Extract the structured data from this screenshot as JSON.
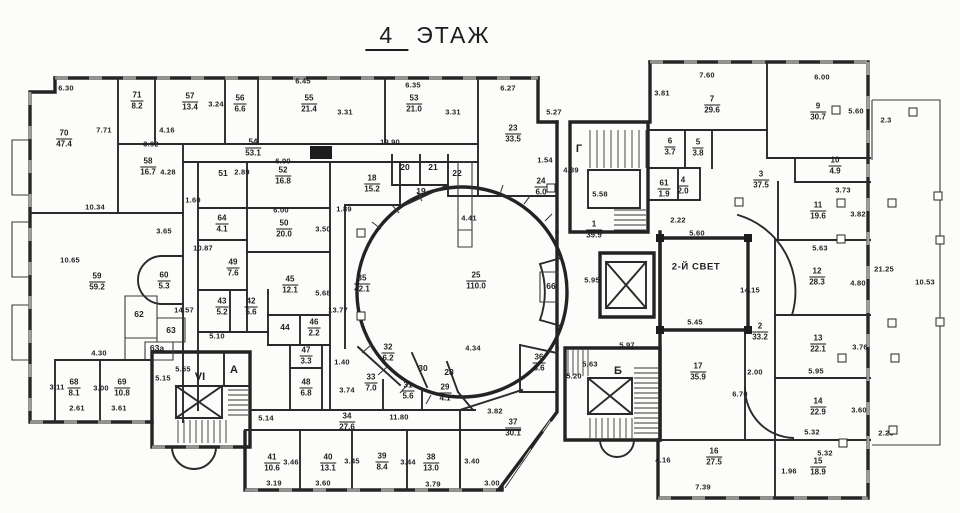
{
  "title": {
    "number": "4",
    "word": "ЭТАЖ"
  },
  "plan": {
    "ink": "#1f1f1f",
    "rooms": [
      {
        "num": "70",
        "area": "47.4",
        "pos": [
          64,
          139
        ]
      },
      {
        "num": "71",
        "area": "8.2",
        "pos": [
          137,
          101
        ]
      },
      {
        "num": "57",
        "area": "13.4",
        "pos": [
          190,
          102
        ]
      },
      {
        "num": "56",
        "area": "6.6",
        "pos": [
          240,
          104
        ]
      },
      {
        "num": "55",
        "area": "21.4",
        "pos": [
          309,
          104
        ]
      },
      {
        "num": "53",
        "area": "21.0",
        "pos": [
          414,
          104
        ]
      },
      {
        "num": "23",
        "area": "33.5",
        "pos": [
          513,
          134
        ]
      },
      {
        "num": "54",
        "area": "53.1",
        "pos": [
          253,
          148
        ]
      },
      {
        "num": "58",
        "area": "16.7",
        "pos": [
          148,
          167
        ]
      },
      {
        "num": "52",
        "area": "16.8",
        "pos": [
          283,
          176
        ]
      },
      {
        "num": "18",
        "area": "15.2",
        "pos": [
          372,
          184
        ]
      },
      {
        "num": "24",
        "area": "6.0",
        "pos": [
          541,
          187
        ]
      },
      {
        "num": "64",
        "area": "4.1",
        "pos": [
          222,
          224
        ]
      },
      {
        "num": "50",
        "area": "20.0",
        "pos": [
          284,
          229
        ]
      },
      {
        "num": "49",
        "area": "7.6",
        "pos": [
          233,
          268
        ]
      },
      {
        "num": "59",
        "area": "59.2",
        "pos": [
          97,
          282
        ]
      },
      {
        "num": "60",
        "area": "5.3",
        "pos": [
          164,
          281
        ]
      },
      {
        "num": "45",
        "area": "12.1",
        "pos": [
          290,
          285
        ]
      },
      {
        "num": "35",
        "area": "42.1",
        "pos": [
          362,
          284
        ]
      },
      {
        "num": "25",
        "area": "110.0",
        "pos": [
          476,
          281
        ]
      },
      {
        "num": "43",
        "area": "5.2",
        "pos": [
          222,
          307
        ]
      },
      {
        "num": "42",
        "area": "5.6",
        "pos": [
          251,
          307
        ]
      },
      {
        "num": "46",
        "area": "2.2",
        "pos": [
          314,
          328
        ]
      },
      {
        "num": "47",
        "area": "3.3",
        "pos": [
          306,
          356
        ]
      },
      {
        "num": "48",
        "area": "6.8",
        "pos": [
          306,
          388
        ]
      },
      {
        "num": "32",
        "area": "6.2",
        "pos": [
          388,
          353
        ]
      },
      {
        "num": "33",
        "area": "7.0",
        "pos": [
          371,
          383
        ]
      },
      {
        "num": "31",
        "area": "5.6",
        "pos": [
          408,
          391
        ]
      },
      {
        "num": "29",
        "area": "4.1",
        "pos": [
          445,
          393
        ]
      },
      {
        "num": "34",
        "area": "27.6",
        "pos": [
          347,
          422
        ]
      },
      {
        "num": "68",
        "area": "8.1",
        "pos": [
          74,
          388
        ]
      },
      {
        "num": "69",
        "area": "10.8",
        "pos": [
          122,
          388
        ]
      },
      {
        "num": "41",
        "area": "10.6",
        "pos": [
          272,
          463
        ]
      },
      {
        "num": "40",
        "area": "13.1",
        "pos": [
          328,
          463
        ]
      },
      {
        "num": "39",
        "area": "8.4",
        "pos": [
          382,
          462
        ]
      },
      {
        "num": "38",
        "area": "13.0",
        "pos": [
          431,
          463
        ]
      },
      {
        "num": "37",
        "area": "30.1",
        "pos": [
          513,
          428
        ]
      },
      {
        "num": "36",
        "area": "6.6",
        "pos": [
          539,
          363
        ]
      },
      {
        "num": "1",
        "area": "39.9",
        "pos": [
          594,
          230
        ]
      },
      {
        "num": "7",
        "area": "29.6",
        "pos": [
          712,
          105
        ]
      },
      {
        "num": "9",
        "area": "30.7",
        "pos": [
          818,
          112
        ]
      },
      {
        "num": "6",
        "area": "3.7",
        "pos": [
          670,
          147
        ]
      },
      {
        "num": "5",
        "area": "3.8",
        "pos": [
          698,
          148
        ]
      },
      {
        "num": "61",
        "area": "1.9",
        "pos": [
          664,
          189
        ]
      },
      {
        "num": "4",
        "area": "2.0",
        "pos": [
          683,
          186
        ]
      },
      {
        "num": "3",
        "area": "37.5",
        "pos": [
          761,
          180
        ]
      },
      {
        "num": "10",
        "area": "4.9",
        "pos": [
          835,
          166
        ]
      },
      {
        "num": "11",
        "area": "19.6",
        "pos": [
          818,
          211
        ]
      },
      {
        "num": "12",
        "area": "28.3",
        "pos": [
          817,
          277
        ]
      },
      {
        "num": "2",
        "area": "33.2",
        "pos": [
          760,
          332
        ]
      },
      {
        "num": "13",
        "area": "22.1",
        "pos": [
          818,
          344
        ]
      },
      {
        "num": "17",
        "area": "35.9",
        "pos": [
          698,
          372
        ]
      },
      {
        "num": "14",
        "area": "22.9",
        "pos": [
          818,
          407
        ]
      },
      {
        "num": "16",
        "area": "27.5",
        "pos": [
          714,
          457
        ]
      },
      {
        "num": "15",
        "area": "18.9",
        "pos": [
          818,
          467
        ]
      }
    ],
    "cells": [
      {
        "num": "51",
        "pos": [
          223,
          173
        ]
      },
      {
        "num": "20",
        "pos": [
          405,
          167
        ]
      },
      {
        "num": "21",
        "pos": [
          433,
          167
        ]
      },
      {
        "num": "22",
        "pos": [
          457,
          173
        ]
      },
      {
        "num": "19",
        "pos": [
          421,
          191
        ]
      },
      {
        "num": "30",
        "pos": [
          423,
          368
        ]
      },
      {
        "num": "28",
        "pos": [
          449,
          372
        ]
      },
      {
        "num": "44",
        "pos": [
          285,
          327
        ]
      },
      {
        "num": "62",
        "pos": [
          139,
          314
        ]
      },
      {
        "num": "63",
        "pos": [
          171,
          330
        ]
      },
      {
        "num": "63а",
        "pos": [
          157,
          348
        ]
      },
      {
        "num": "66",
        "pos": [
          551,
          286
        ]
      }
    ],
    "zones": [
      {
        "label": "Г",
        "pos": [
          579,
          149
        ],
        "wide": false
      },
      {
        "label": "Б",
        "pos": [
          618,
          371
        ],
        "wide": false
      },
      {
        "label": "VI",
        "pos": [
          200,
          377
        ],
        "wide": false
      },
      {
        "label": "А",
        "pos": [
          234,
          370
        ],
        "wide": false
      },
      {
        "label": "2-Й СВЕТ",
        "pos": [
          696,
          267
        ],
        "wide": true
      }
    ],
    "dims": [
      {
        "t": "6.30",
        "pos": [
          66,
          88
        ]
      },
      {
        "t": "7.71",
        "pos": [
          104,
          130
        ],
        "v": true
      },
      {
        "t": "3.92",
        "pos": [
          151,
          144
        ]
      },
      {
        "t": "4.16",
        "pos": [
          167,
          130
        ]
      },
      {
        "t": "3.24",
        "pos": [
          216,
          104
        ],
        "v": true
      },
      {
        "t": "6.45",
        "pos": [
          303,
          81
        ]
      },
      {
        "t": "3.31",
        "pos": [
          345,
          112
        ],
        "v": true
      },
      {
        "t": "6.35",
        "pos": [
          413,
          85
        ]
      },
      {
        "t": "3.31",
        "pos": [
          453,
          112
        ],
        "v": true
      },
      {
        "t": "6.27",
        "pos": [
          508,
          88
        ]
      },
      {
        "t": "5.27",
        "pos": [
          554,
          112
        ],
        "v": true
      },
      {
        "t": "19.90",
        "pos": [
          390,
          142
        ]
      },
      {
        "t": "2.89",
        "pos": [
          242,
          172
        ],
        "v": true
      },
      {
        "t": "4.28",
        "pos": [
          168,
          172
        ],
        "v": true
      },
      {
        "t": "1.60",
        "pos": [
          193,
          200
        ]
      },
      {
        "t": "6.00",
        "pos": [
          283,
          161
        ]
      },
      {
        "t": "6.00",
        "pos": [
          281,
          210
        ]
      },
      {
        "t": "1.89",
        "pos": [
          344,
          209
        ]
      },
      {
        "t": "3.50",
        "pos": [
          323,
          229
        ],
        "v": true
      },
      {
        "t": "5.68",
        "pos": [
          323,
          293
        ],
        "v": true
      },
      {
        "t": "13.77",
        "pos": [
          338,
          310
        ],
        "v": true
      },
      {
        "t": "10.34",
        "pos": [
          95,
          207
        ]
      },
      {
        "t": "3.65",
        "pos": [
          164,
          231
        ],
        "v": true
      },
      {
        "t": "10.65",
        "pos": [
          70,
          260
        ],
        "v": true
      },
      {
        "t": "10.87",
        "pos": [
          203,
          248
        ],
        "v": true
      },
      {
        "t": "1.54",
        "pos": [
          545,
          160
        ]
      },
      {
        "t": "4.41",
        "pos": [
          469,
          218
        ],
        "v": true
      },
      {
        "t": "4.39",
        "pos": [
          571,
          170
        ],
        "v": true
      },
      {
        "t": "5.58",
        "pos": [
          600,
          194
        ]
      },
      {
        "t": "3.81",
        "pos": [
          662,
          93
        ],
        "v": true
      },
      {
        "t": "7.60",
        "pos": [
          707,
          75
        ]
      },
      {
        "t": "6.00",
        "pos": [
          822,
          77
        ]
      },
      {
        "t": "5.60",
        "pos": [
          856,
          111
        ],
        "v": true
      },
      {
        "t": "2.3",
        "pos": [
          886,
          120
        ]
      },
      {
        "t": "2.22",
        "pos": [
          678,
          220
        ],
        "v": true
      },
      {
        "t": "3.73",
        "pos": [
          843,
          190
        ]
      },
      {
        "t": "3.82",
        "pos": [
          858,
          214
        ],
        "v": true
      },
      {
        "t": "5.63",
        "pos": [
          820,
          248
        ]
      },
      {
        "t": "4.80",
        "pos": [
          858,
          283
        ],
        "v": true
      },
      {
        "t": "21.25",
        "pos": [
          884,
          269
        ],
        "v": true
      },
      {
        "t": "10.53",
        "pos": [
          925,
          282
        ],
        "v": true
      },
      {
        "t": "3.76",
        "pos": [
          860,
          347
        ],
        "v": true
      },
      {
        "t": "14.15",
        "pos": [
          750,
          290
        ],
        "v": true
      },
      {
        "t": "5.60",
        "pos": [
          697,
          233
        ]
      },
      {
        "t": "5.95",
        "pos": [
          592,
          280
        ]
      },
      {
        "t": "5.45",
        "pos": [
          695,
          322
        ]
      },
      {
        "t": "5.97",
        "pos": [
          627,
          345
        ]
      },
      {
        "t": "2.00",
        "pos": [
          755,
          372
        ]
      },
      {
        "t": "6.70",
        "pos": [
          740,
          394
        ],
        "v": true
      },
      {
        "t": "5.95",
        "pos": [
          816,
          371
        ]
      },
      {
        "t": "5.32",
        "pos": [
          812,
          432
        ]
      },
      {
        "t": "3.60",
        "pos": [
          859,
          410
        ],
        "v": true
      },
      {
        "t": "2.25",
        "pos": [
          886,
          433
        ]
      },
      {
        "t": "5.32",
        "pos": [
          825,
          453
        ]
      },
      {
        "t": "1.96",
        "pos": [
          789,
          471
        ],
        "v": true
      },
      {
        "t": "7.39",
        "pos": [
          703,
          487
        ]
      },
      {
        "t": "4.16",
        "pos": [
          663,
          460
        ],
        "v": true
      },
      {
        "t": "4.30",
        "pos": [
          99,
          353
        ]
      },
      {
        "t": "3.11",
        "pos": [
          57,
          387
        ],
        "v": true
      },
      {
        "t": "2.61",
        "pos": [
          77,
          408
        ]
      },
      {
        "t": "3.00",
        "pos": [
          101,
          388
        ],
        "v": true
      },
      {
        "t": "3.61",
        "pos": [
          119,
          408
        ]
      },
      {
        "t": "5.55",
        "pos": [
          183,
          369
        ]
      },
      {
        "t": "5.15",
        "pos": [
          163,
          378
        ],
        "v": true
      },
      {
        "t": "5.14",
        "pos": [
          266,
          418
        ],
        "v": true
      },
      {
        "t": "14.57",
        "pos": [
          184,
          310
        ],
        "v": true
      },
      {
        "t": "5.10",
        "pos": [
          217,
          336
        ]
      },
      {
        "t": "1.40",
        "pos": [
          342,
          362
        ]
      },
      {
        "t": "3.74",
        "pos": [
          347,
          390
        ],
        "v": true
      },
      {
        "t": "11.80",
        "pos": [
          399,
          417
        ]
      },
      {
        "t": "3.19",
        "pos": [
          274,
          483
        ]
      },
      {
        "t": "3.46",
        "pos": [
          291,
          462
        ],
        "v": true
      },
      {
        "t": "3.60",
        "pos": [
          323,
          483
        ]
      },
      {
        "t": "3.45",
        "pos": [
          352,
          461
        ],
        "v": true
      },
      {
        "t": "3.44",
        "pos": [
          408,
          462
        ],
        "v": true
      },
      {
        "t": "3.79",
        "pos": [
          433,
          484
        ]
      },
      {
        "t": "3.40",
        "pos": [
          472,
          461
        ],
        "v": true
      },
      {
        "t": "3.00",
        "pos": [
          492,
          483
        ]
      },
      {
        "t": "3.82",
        "pos": [
          495,
          411
        ],
        "v": true
      },
      {
        "t": "4.34",
        "pos": [
          473,
          348
        ],
        "v": true
      },
      {
        "t": "5.20",
        "pos": [
          574,
          376
        ],
        "v": true
      },
      {
        "t": "5.63",
        "pos": [
          590,
          364
        ]
      }
    ],
    "columns": [
      [
        361,
        233
      ],
      [
        361,
        316
      ],
      [
        551,
        188
      ],
      [
        836,
        110
      ],
      [
        739,
        202
      ],
      [
        841,
        203
      ],
      [
        841,
        239
      ],
      [
        892,
        203
      ],
      [
        892,
        323
      ],
      [
        940,
        240
      ],
      [
        940,
        322
      ],
      [
        842,
        358
      ],
      [
        895,
        358
      ],
      [
        843,
        443
      ],
      [
        913,
        112
      ],
      [
        938,
        196
      ],
      [
        893,
        430
      ]
    ]
  }
}
